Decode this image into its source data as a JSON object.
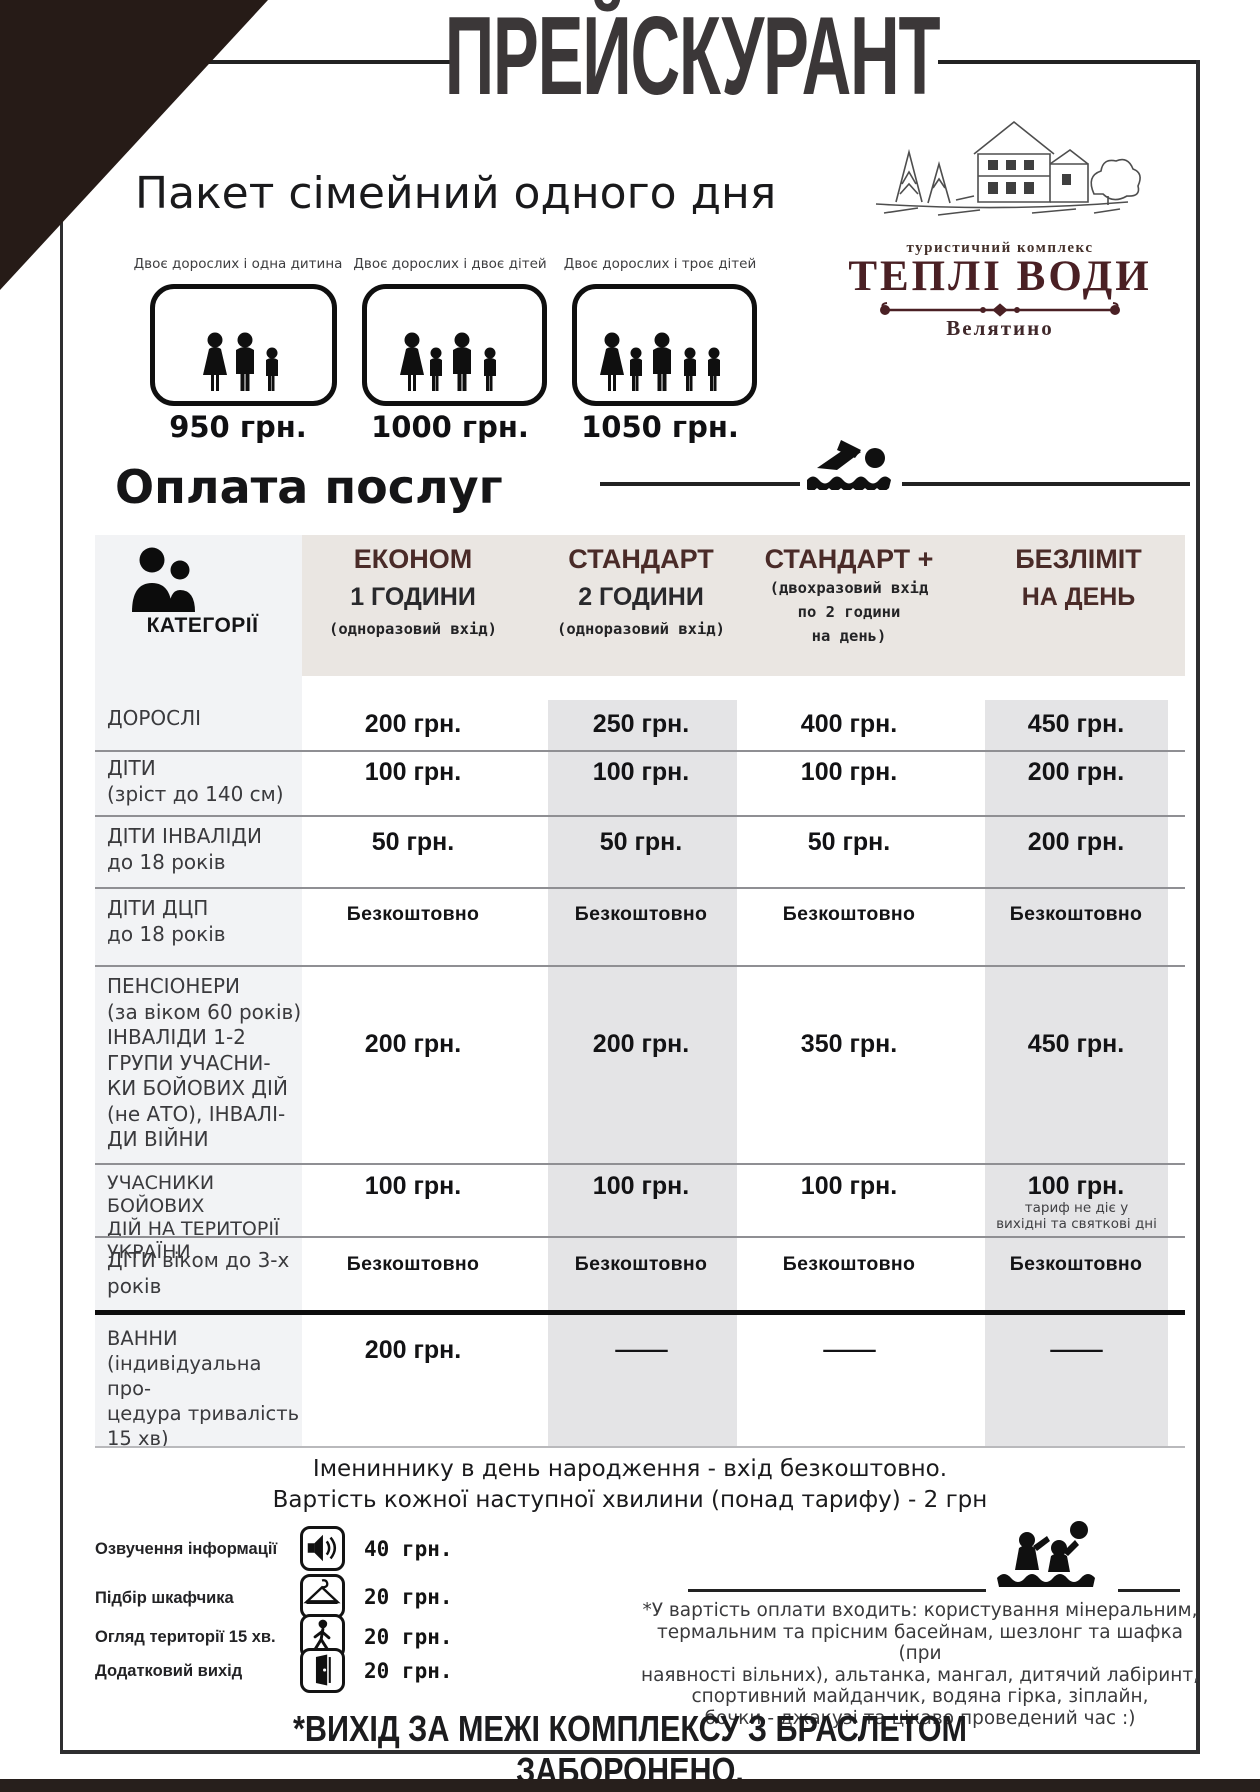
{
  "title": "ПРЕЙСКУРАНТ",
  "logo": {
    "tagline": "туристичний комплекс",
    "name": "ТЕПЛІ ВОДИ",
    "location": "Велятино"
  },
  "family_package": {
    "heading": "Пакет сімейний одного дня",
    "options": [
      {
        "label": "Двоє дорослих і одна дитина",
        "price": "950 грн."
      },
      {
        "label": "Двоє дорослих і двоє дітей",
        "price": "1000 грн."
      },
      {
        "label": "Двоє дорослих і троє дітей",
        "price": "1050 грн."
      }
    ]
  },
  "payment_heading": "Оплата послуг",
  "table": {
    "category_header": "КАТЕГОРІЇ",
    "columns": [
      {
        "title": "ЕКОНОМ",
        "subtitle": "1 ГОДИНИ",
        "note": "(одноразовий вхід)"
      },
      {
        "title": "СТАНДАРТ",
        "subtitle": "2 ГОДИНИ",
        "note": "(одноразовий вхід)"
      },
      {
        "title": "СТАНДАРТ +",
        "subtitle": "",
        "note": "(двохразовий  вхід\nпо 2 години\nна день)"
      },
      {
        "title": "БЕЗЛІМІТ",
        "subtitle": "НА ДЕНЬ",
        "note": ""
      }
    ],
    "rows": [
      {
        "category": "ДОРОСЛІ",
        "values": [
          "200 грн.",
          "250 грн.",
          "400 грн.",
          "450 грн."
        ]
      },
      {
        "category": "ДІТИ\n(зріст до 140 см)",
        "values": [
          "100 грн.",
          "100 грн.",
          "100 грн.",
          "200 грн."
        ]
      },
      {
        "category": "ДІТИ ІНВАЛІДИ\nдо 18 років",
        "values": [
          "50 грн.",
          "50 грн.",
          "50 грн.",
          "200 грн."
        ]
      },
      {
        "category": "ДІТИ ДЦП\nдо 18 років",
        "values": [
          "Безкоштовно",
          "Безкоштовно",
          "Безкоштовно",
          "Безкоштовно"
        ]
      },
      {
        "category": "ПЕНСІОНЕРИ\n(за віком 60 років)\nІНВАЛІДИ 1-2\nГРУПИ УЧАСНИ-\nКИ БОЙОВИХ ДІЙ\n(не АТО), ІНВАЛІ-\nДИ ВІЙНИ",
        "values": [
          "200 грн.",
          "200 грн.",
          "350 грн.",
          "450 грн."
        ]
      },
      {
        "category": "УЧАСНИКИ БОЙОВИХ\nДІЙ НА ТЕРИТОРІЇ\nУКРАЇНИ",
        "values": [
          "100 грн.",
          "100 грн.",
          "100 грн.",
          "100 грн."
        ],
        "value4_note": "тариф не діє у\nвихідні та святкові дні"
      },
      {
        "category": "ДІТИ віком до 3-х\nроків",
        "values": [
          "Безкоштовно",
          "Безкоштовно",
          "Безкоштовно",
          "Безкоштовно"
        ]
      },
      {
        "category": "ВАННИ\n(індивідуальна про-\nцедура тривалість\n15 хв)",
        "values": [
          "200 грн.",
          "—",
          "—",
          "—"
        ]
      }
    ]
  },
  "notes": [
    "Імениннику в день народження - вхід безкоштовно.",
    "Вартість кожної наступної хвилини (понад тарифу) - 2 грн"
  ],
  "extra_services": [
    {
      "label": "Озвучення інформації",
      "icon": "speaker-icon",
      "price": "40 грн."
    },
    {
      "label": "Підбір шкафчика",
      "icon": "hanger-icon",
      "price": "20 грн."
    },
    {
      "label": "Огляд території  15 хв.",
      "icon": "walking-person-icon",
      "price": "20 грн."
    },
    {
      "label": "Додатковий вихід",
      "icon": "door-icon",
      "price": "20 грн."
    }
  ],
  "included_note": "*У вартість оплати входить: користування мінеральним,\nтермальним та прісним басейнам, шезлонг та шафка (при\nнаявності вільних), альтанка, мангал, дитячий лабіринт,\nспортивний майданчик, водяна гірка, зіплайн,\nбочки - джакузі та цікаво проведений час :)",
  "warning": "*ВИХІД ЗА МЕЖІ КОМПЛЕКСУ З БРАСЛЕТОМ ЗАБОРОНЕНО.",
  "colors": {
    "accent_maroon": "#4a2b28",
    "logo_maroon": "#4a2024",
    "header_band": "#eae6e2",
    "column_stripe": "#e4e4e6",
    "category_column": "#f2f3f5",
    "corner_triangle": "#261b17",
    "ink": "#1d1d1f"
  }
}
